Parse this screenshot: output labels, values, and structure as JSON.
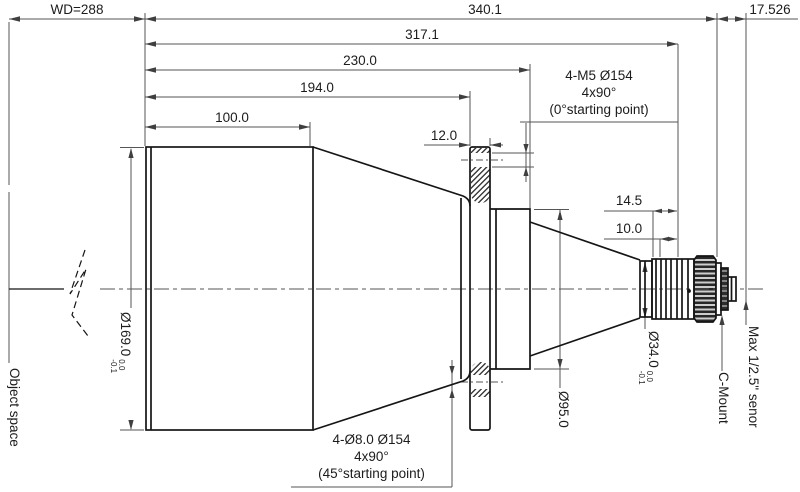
{
  "dimensions": {
    "working_distance": "WD=288",
    "total_length": "340.1",
    "flange_to_image": "17.526",
    "len_317": "317.1",
    "len_230": "230.0",
    "len_194": "194.0",
    "len_100": "100.0",
    "len_12": "12.0",
    "len_14_5": "14.5",
    "len_10": "10.0",
    "dia_169": {
      "text": "Ø169.0",
      "tol_upper": "0.0",
      "tol_lower": "-0.1"
    },
    "dia_95": "Ø95.0",
    "dia_34": {
      "text": "Ø34.0",
      "tol_upper": "0.0",
      "tol_lower": "-0.1"
    }
  },
  "annotations": {
    "m5_holes": {
      "line1": "4-M5 Ø154",
      "line2": "4x90°",
      "line3": "(0°starting point)"
    },
    "d8_holes": {
      "line1": "4-Ø8.0  Ø154",
      "line2": "4x90°",
      "line3": "(45°starting point)"
    },
    "object_space": "Object space",
    "c_mount": "C-Mount",
    "max_sensor": "Max 1/2.5\" senor"
  },
  "colors": {
    "background": "#ffffff",
    "object_line": "#151515",
    "dim_line": "#565656",
    "text": "#1c1c1c"
  }
}
